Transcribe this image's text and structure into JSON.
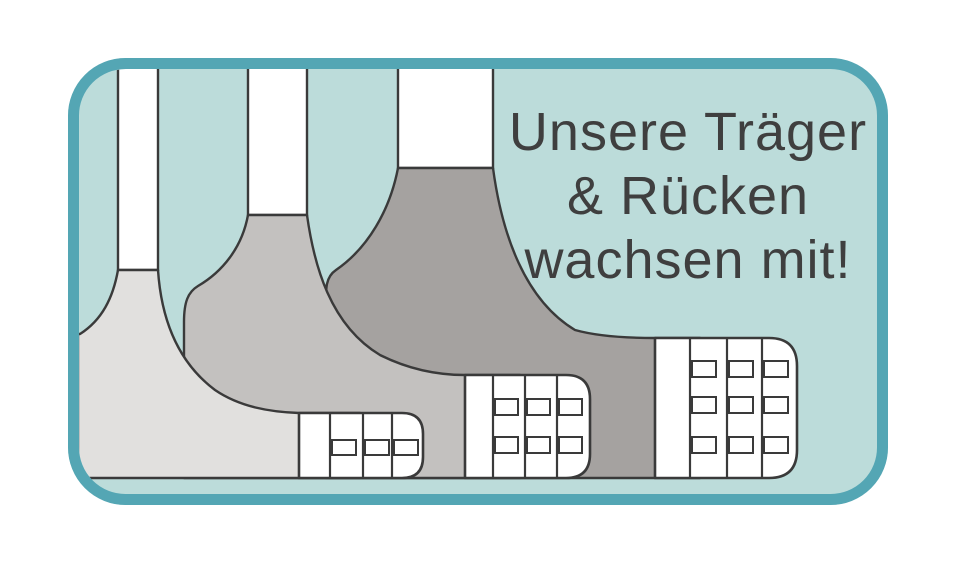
{
  "title": {
    "lines": [
      "Unsere Träger",
      "& Rücken",
      "wachsen mit!"
    ]
  },
  "colors": {
    "page_bg": "#ffffff",
    "panel_bg": "#bcdcda",
    "border": "#54a6b4",
    "outline": "#3a3a3a",
    "text": "#3f3f3f",
    "white": "#ffffff",
    "gray_small": "#e1e0de",
    "gray_medium": "#c3c1bf",
    "gray_large": "#a5a2a0"
  },
  "bands": [
    {
      "size": "small",
      "hook_rows": 1,
      "hook_columns": 3
    },
    {
      "size": "medium",
      "hook_rows": 2,
      "hook_columns": 3
    },
    {
      "size": "large",
      "hook_rows": 3,
      "hook_columns": 3
    }
  ]
}
